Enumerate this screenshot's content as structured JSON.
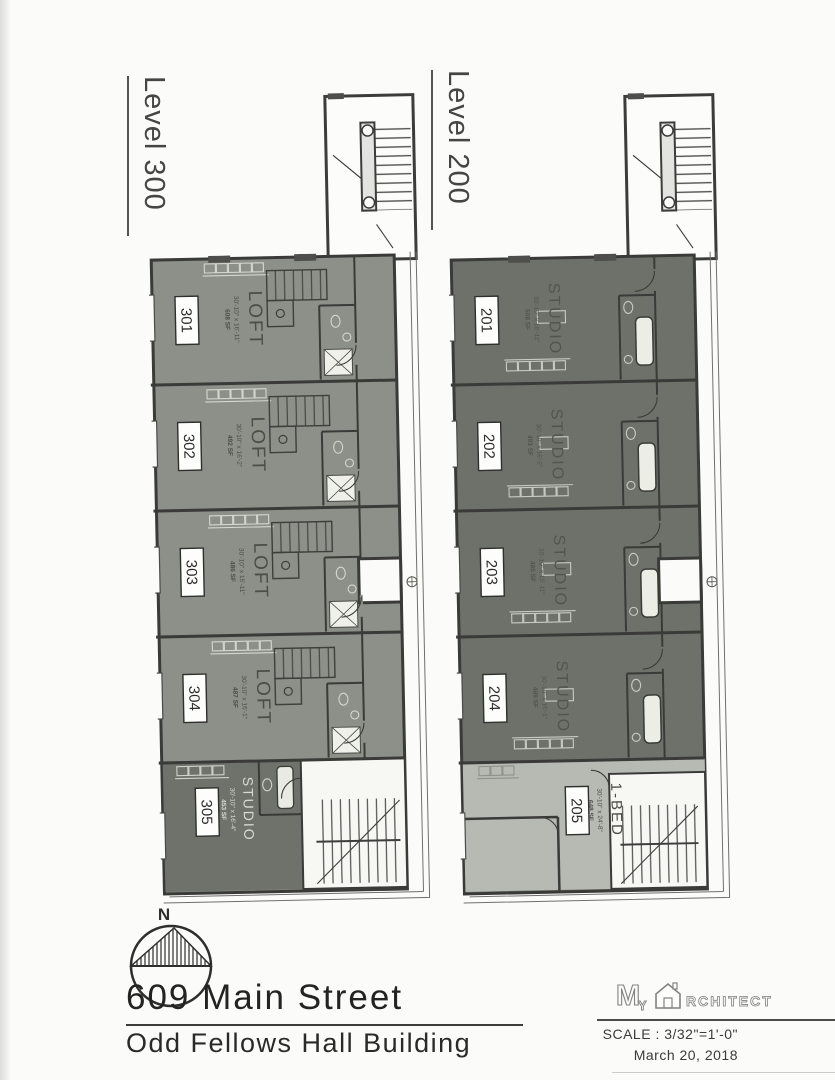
{
  "plans": [
    {
      "level_label": "Level 300",
      "units": [
        {
          "number": "301",
          "type": "LOFT",
          "dims": "30'-10\" x 16'-11\"",
          "area": "608 SF"
        },
        {
          "number": "302",
          "type": "LOFT",
          "dims": "30'-10\" x 16'-2\"",
          "area": "492 SF"
        },
        {
          "number": "303",
          "type": "LOFT",
          "dims": "30'-10\" x 15'-11\"",
          "area": "486 SF"
        },
        {
          "number": "304",
          "type": "LOFT",
          "dims": "30'-10\" x 16'-1\"",
          "area": "487 SF"
        },
        {
          "number": "305",
          "type": "STUDIO",
          "dims": "30'-10\" x 16'-4\"",
          "area": "453 SF"
        }
      ]
    },
    {
      "level_label": "Level 200",
      "units": [
        {
          "number": "201",
          "type": "STUDIO",
          "dims": "30'-10\" x 16'-11\"",
          "area": "508 SF"
        },
        {
          "number": "202",
          "type": "STUDIO",
          "dims": "30'-10\" x 16'-2\"",
          "area": "493 SF"
        },
        {
          "number": "203",
          "type": "STUDIO",
          "dims": "30'-10\" x 15'-11\"",
          "area": "485 SF"
        },
        {
          "number": "204",
          "type": "STUDIO",
          "dims": "30'-10\" x 16'-1\"",
          "area": "489 SF"
        },
        {
          "number": "205",
          "type": "1-BED",
          "dims": "30'-10\" x 24'-8\"",
          "area": "648 SF"
        }
      ]
    }
  ],
  "compass": {
    "north_label": "N"
  },
  "title_block": {
    "address": "609 Main Street",
    "building_name": "Odd Fellows Hall Building",
    "scale": "SCALE : 3/32\"=1'-0\"",
    "date": "March 20, 2018",
    "logo": {
      "m": "M",
      "y": "Y",
      "rest": "RCHITECT"
    }
  },
  "colors": {
    "paper": "#fbfbf9",
    "wall_line": "#3a3a38",
    "level300_unit_fill": "#8d9088",
    "level300_studio_fill": "#6f726a",
    "level200_unit_fill": "#6e716a",
    "level200_onebed_fill": "#b7bab2",
    "stair_fill": "#f7f7f4"
  }
}
